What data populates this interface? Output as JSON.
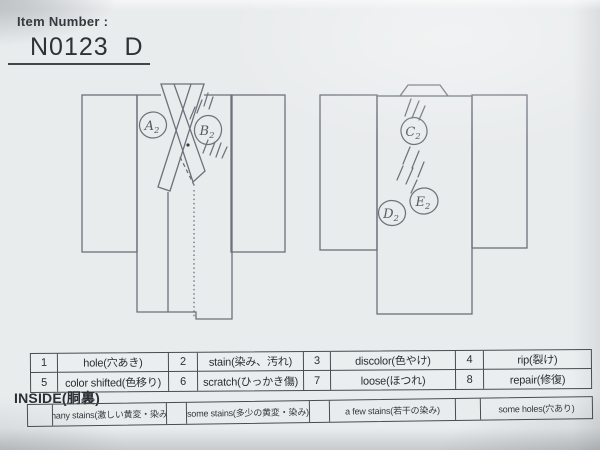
{
  "header": {
    "label": "Item Number :",
    "item_number": "N0123  D"
  },
  "diagrams": {
    "front": {
      "name": "kimono-front-outline",
      "marks": [
        {
          "letter": "A",
          "sub": "2"
        },
        {
          "letter": "B",
          "sub": "2"
        }
      ]
    },
    "back": {
      "name": "kimono-back-outline",
      "marks": [
        {
          "letter": "C",
          "sub": "2"
        },
        {
          "letter": "D",
          "sub": "2"
        },
        {
          "letter": "E",
          "sub": "2"
        }
      ]
    }
  },
  "defect_codes": {
    "rows": [
      [
        {
          "num": "1",
          "label": "hole(穴あき)"
        },
        {
          "num": "2",
          "label": "stain(染み、汚れ)"
        },
        {
          "num": "3",
          "label": "discolor(色やけ)"
        },
        {
          "num": "4",
          "label": "rip(裂け)"
        }
      ],
      [
        {
          "num": "5",
          "label": "color shifted(色移り)"
        },
        {
          "num": "6",
          "label": "scratch(ひっかき傷)"
        },
        {
          "num": "7",
          "label": "loose(ほつれ)"
        },
        {
          "num": "8",
          "label": "repair(修復)"
        }
      ]
    ]
  },
  "inside": {
    "title": "INSIDE(胴裏)",
    "options": [
      {
        "label": "many stains(激しい黄変・染み)"
      },
      {
        "label": "some stains(多少の黄変・染み)"
      },
      {
        "label": "a few stains(若干の染み)"
      },
      {
        "label": "some holes(穴あり)"
      }
    ]
  },
  "colors": {
    "paper": "#e9eced",
    "outline": "#6c717a",
    "pencil": "#6e737b",
    "ink": "#2b2f34",
    "table_border": "#474c52"
  }
}
